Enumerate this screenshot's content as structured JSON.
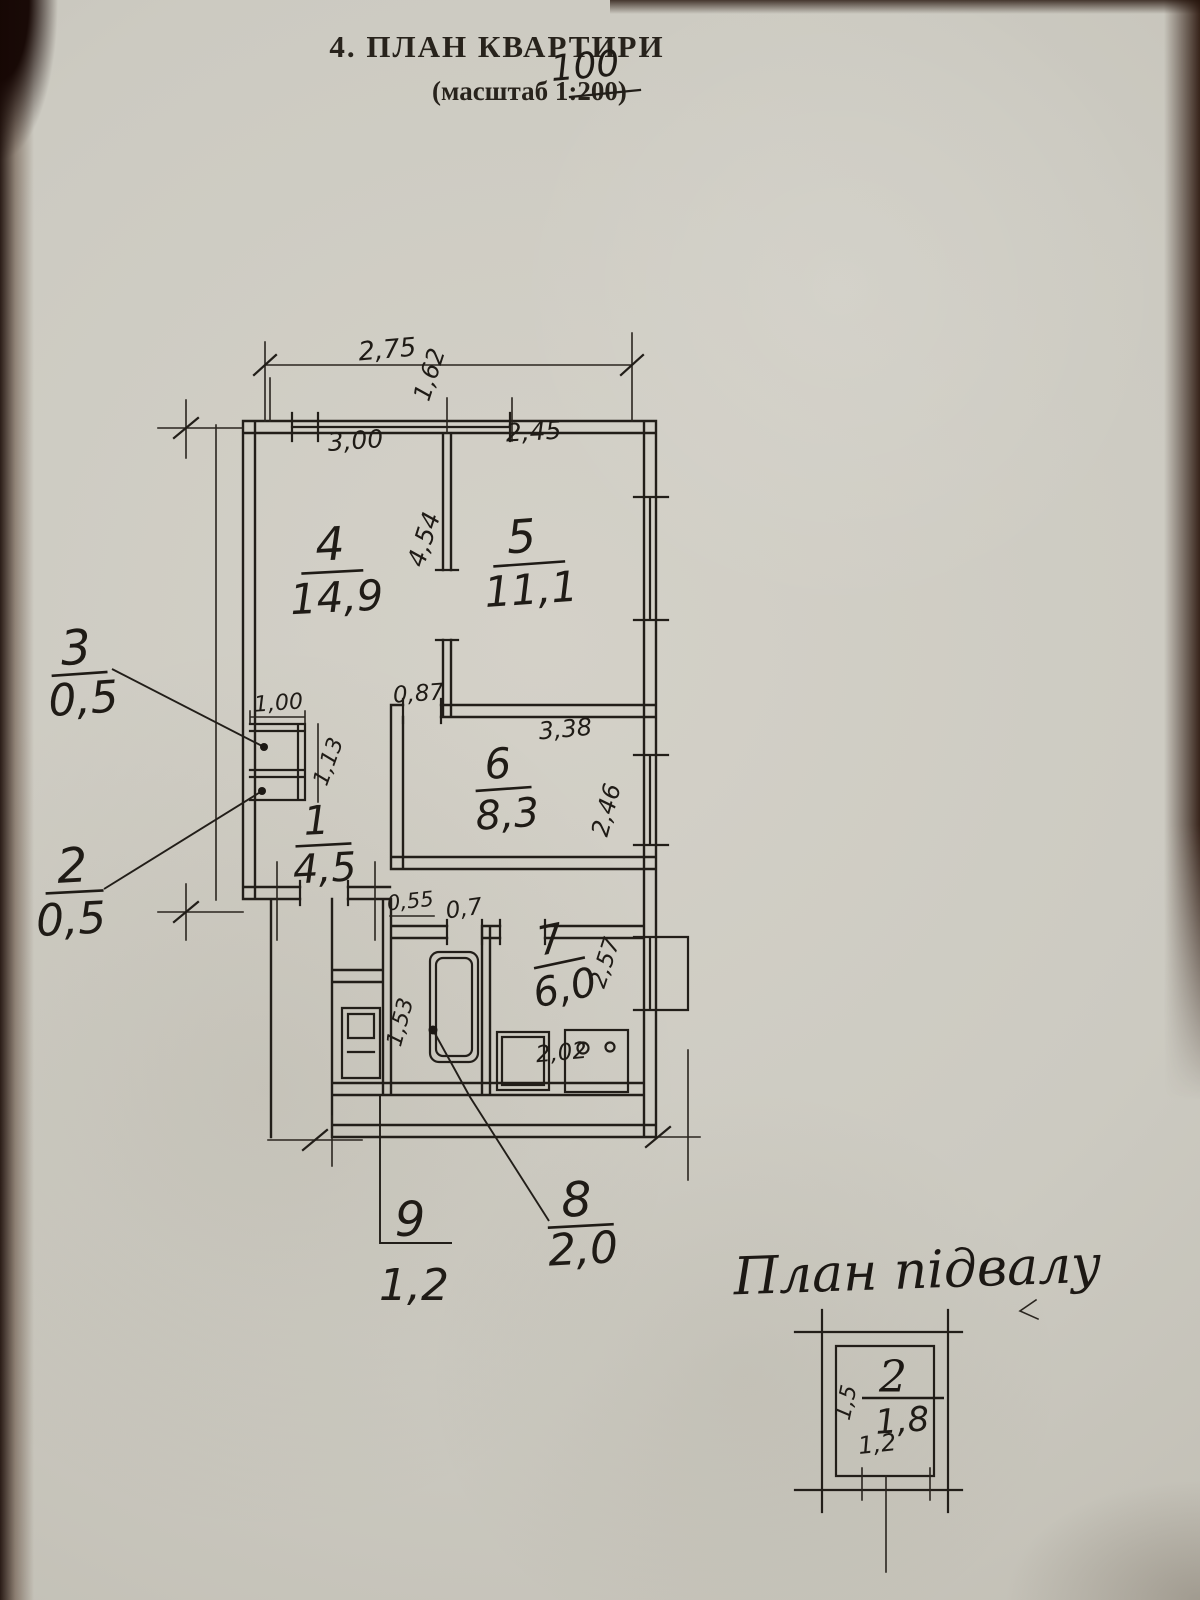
{
  "header": {
    "title": "4. ПЛАН КВАРТИРИ",
    "scale_prefix": "(масштаб 1:",
    "scale_old": "200",
    "scale_suffix": ")",
    "scale_correction": "100"
  },
  "plan": {
    "rooms": [
      {
        "number": "4",
        "area": "14,9"
      },
      {
        "number": "5",
        "area": "11,1"
      },
      {
        "number": "6",
        "area": "8,3"
      },
      {
        "number": "7",
        "area": "6,0"
      },
      {
        "number": "1",
        "area": "4,5"
      }
    ],
    "callouts": [
      {
        "number": "3",
        "area": "0,5"
      },
      {
        "number": "2",
        "area": "0,5"
      },
      {
        "number": "8",
        "area": "2,0"
      },
      {
        "number": "9",
        "area": "1,2"
      }
    ],
    "dimensions": {
      "top_width": "2,75",
      "top_height": "1,62",
      "room4_width": "3,00",
      "room5_width": "2,45",
      "room4_depth": "4,54",
      "room6_door": "0,87",
      "room6_width": "3,38",
      "room6_window": "2,46",
      "closet_width": "1,00",
      "closet_depth": "1,13",
      "hall_door": "0,55",
      "bath_door": "0,7",
      "bath_depth": "1,53",
      "kitchen_depth": "2,57",
      "kitchen_width": "2,02"
    }
  },
  "basement": {
    "title": "План підвалу",
    "number": "2",
    "area": "1,8",
    "width": "1,2",
    "depth": "1,5"
  },
  "colors": {
    "ink": "#211d18",
    "paper": "#cfccc3"
  }
}
